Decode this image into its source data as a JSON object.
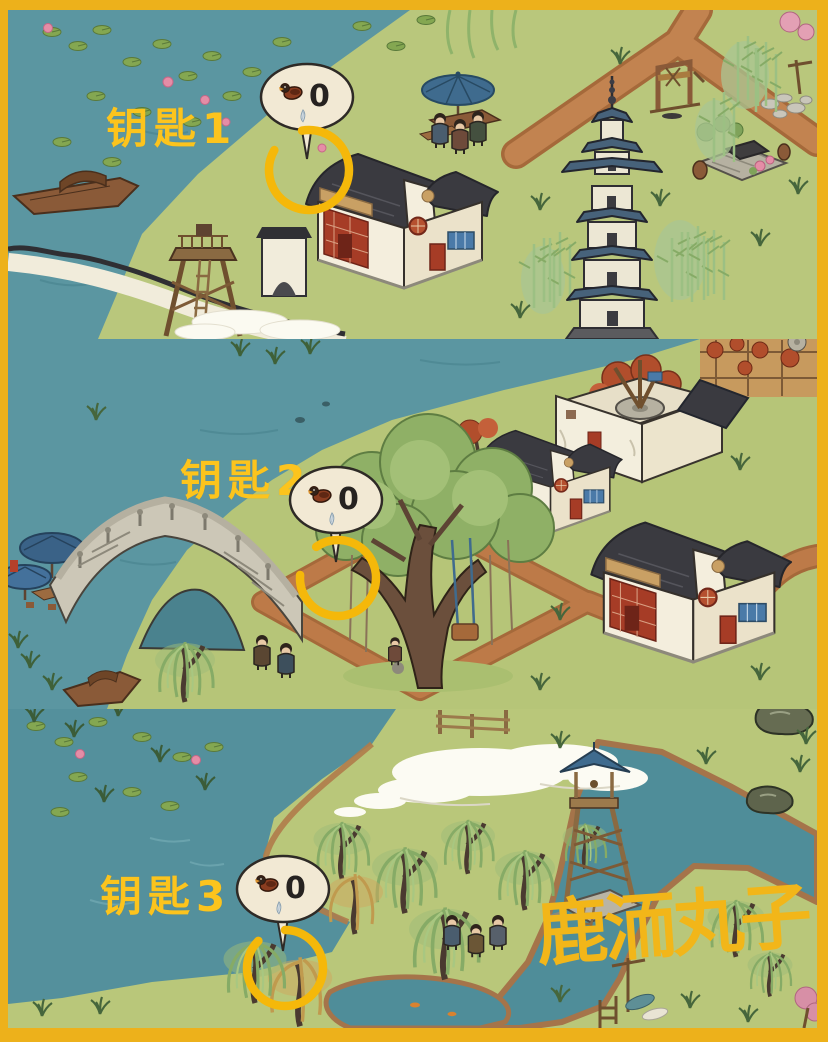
{
  "annotations": {
    "keys": [
      {
        "label": "钥匙1",
        "count": "0"
      },
      {
        "label": "钥匙2",
        "count": "0"
      },
      {
        "label": "钥匙3",
        "count": "0"
      }
    ],
    "bubble_icon": "goose-icon",
    "bubble_secondary_icon": "feather-icon"
  },
  "signature": {
    "text": "鹿洏丸子"
  },
  "colors": {
    "frame_gold": "#edb11b",
    "annotation_yellow": "#fcc41d",
    "marker_gold": "#f5b80a",
    "water_teal": "#5b96a1",
    "grass_green": "#b9c77c",
    "path_tan": "#c28350",
    "roof_dark": "#3a3a40",
    "pagoda_roof_blue": "#47627a",
    "bubble_cream": "#f2e9d4"
  }
}
